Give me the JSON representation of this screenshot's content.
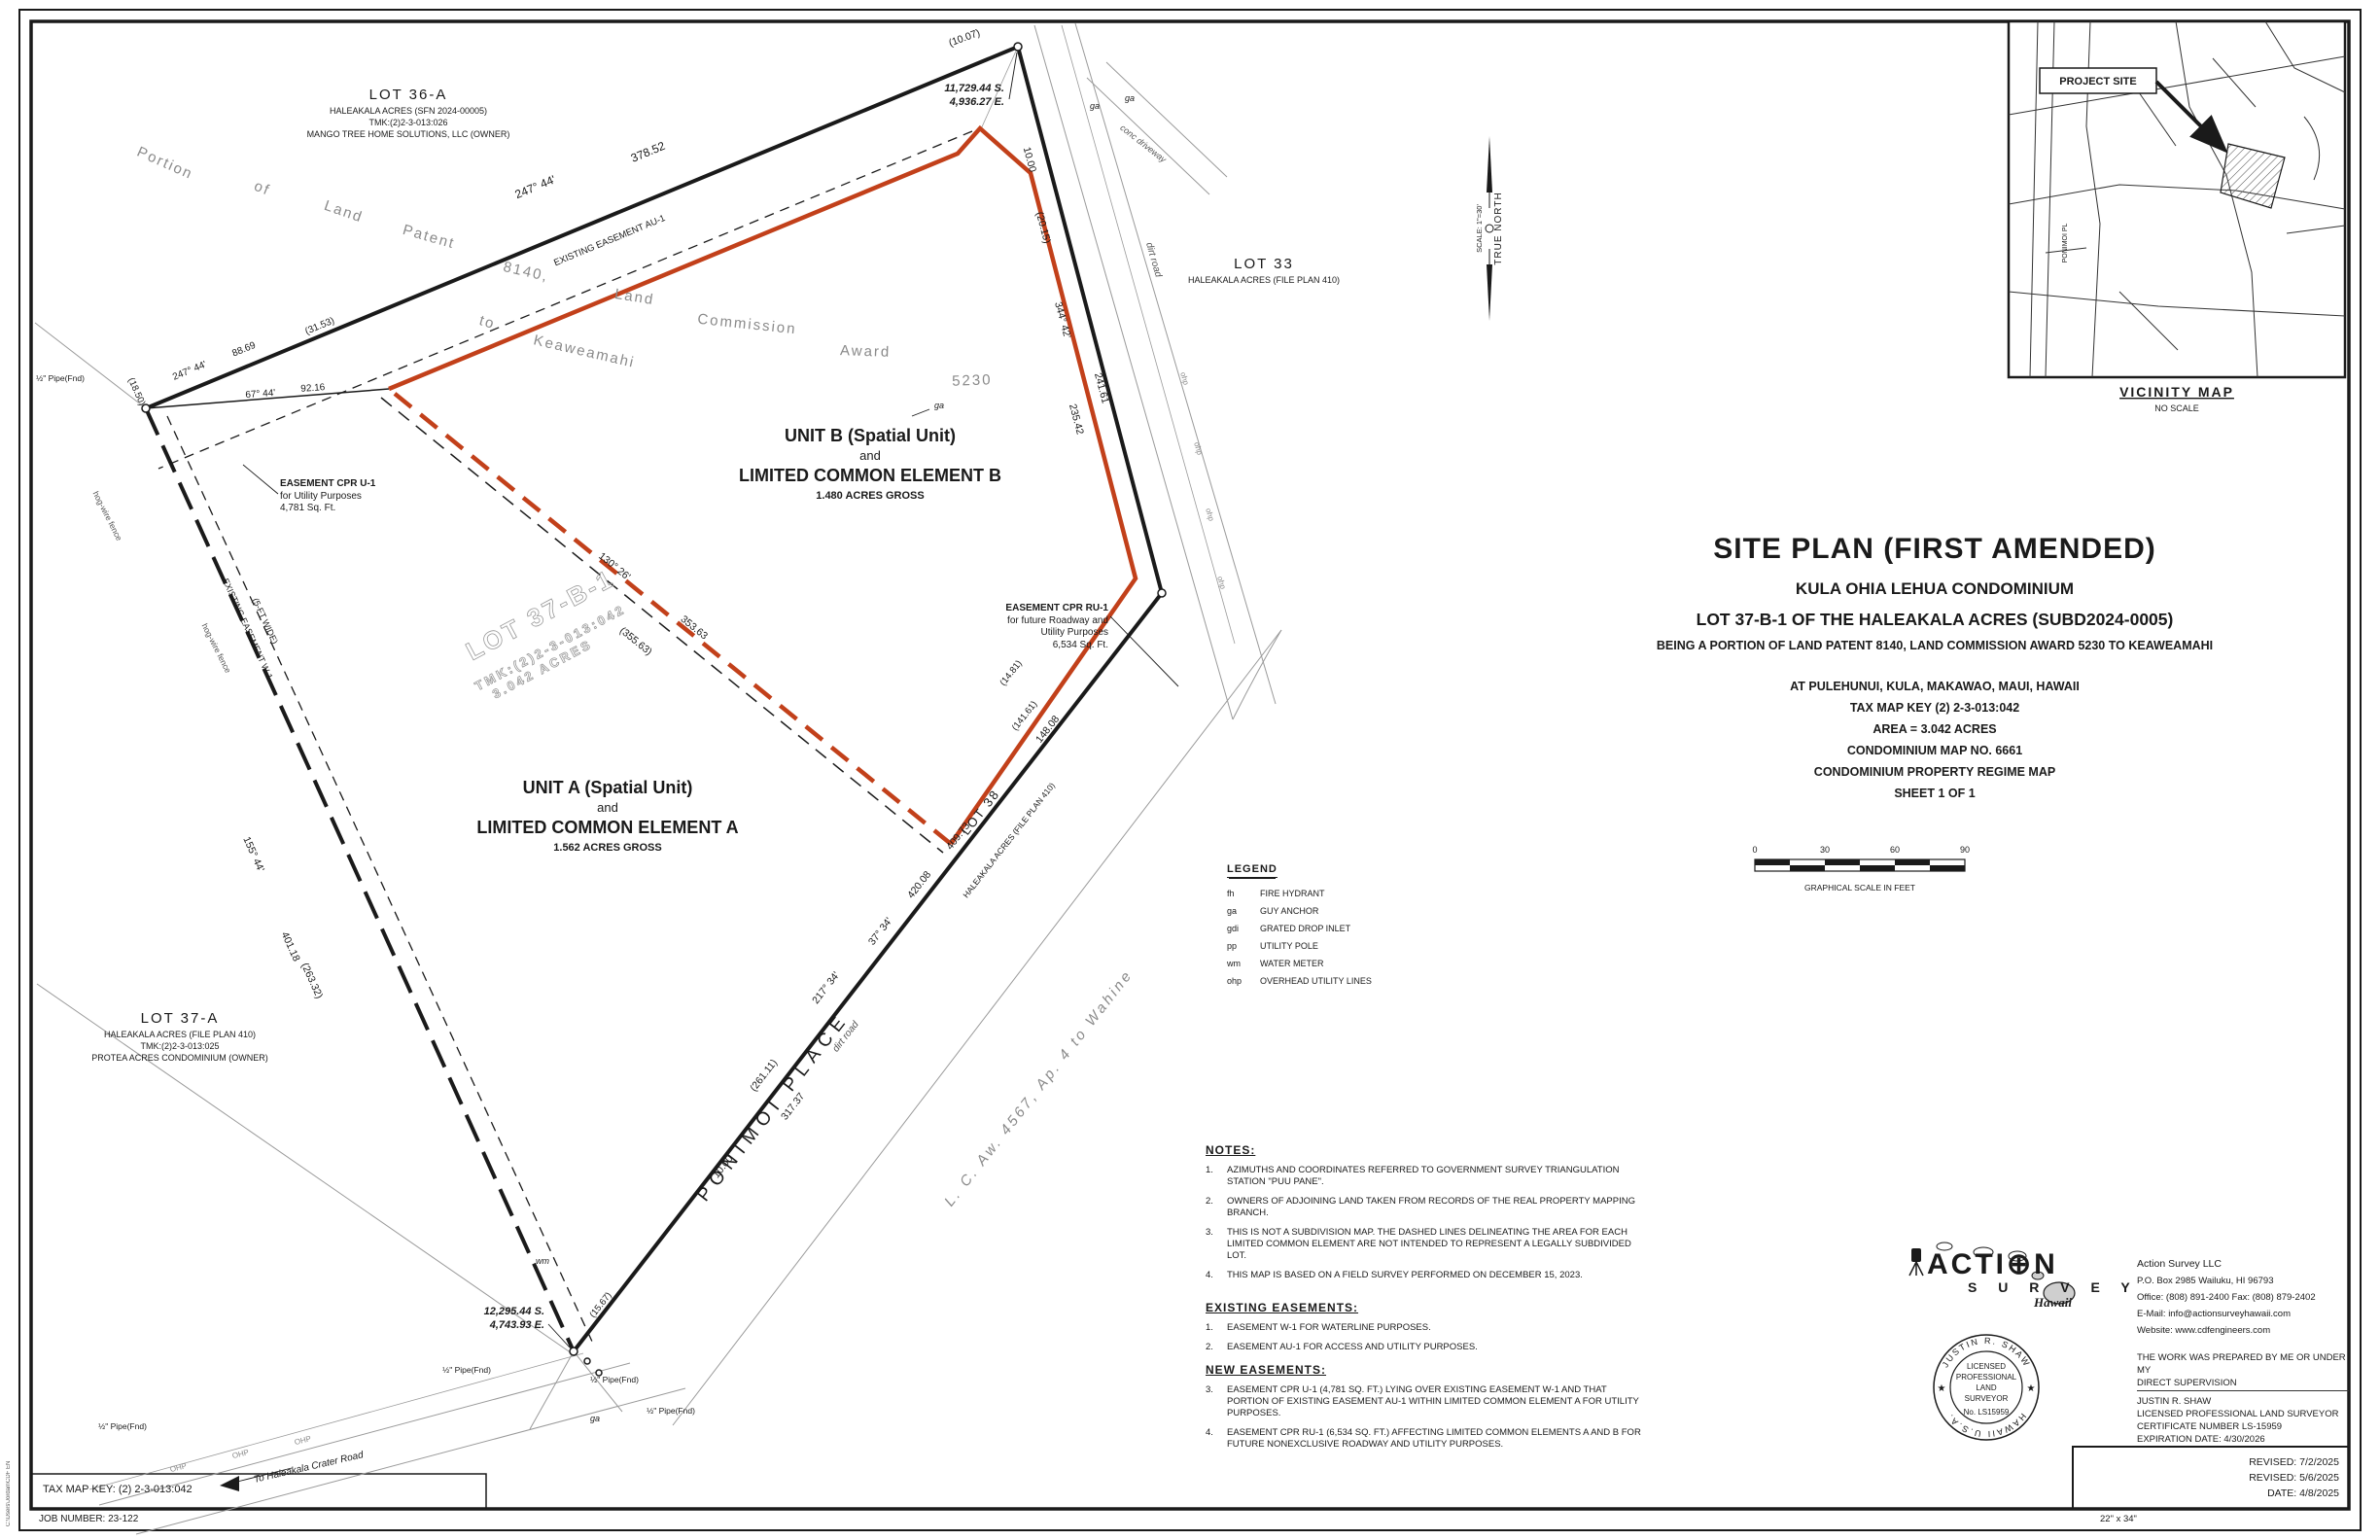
{
  "page": {
    "sheet_note": "22\" x 34\"",
    "tax_map_key": "TAX MAP KEY: (2) 2-3-013:042",
    "job_number": "JOB NUMBER: 23-122",
    "file_path": "C:\\Users\\Jordan\\CDF EN",
    "revisions": [
      "REVISED: 7/2/2025",
      "REVISED: 5/6/2025",
      "DATE: 4/8/2025"
    ]
  },
  "colors": {
    "boundary_red": "#c2401a",
    "line_black": "#1a1a1a",
    "line_gray": "#9a9a9a"
  },
  "vicinity": {
    "title": "VICINITY MAP",
    "subtitle": "NO SCALE",
    "project_site": "PROJECT SITE",
    "road_label": "PONIMOI PL"
  },
  "north": {
    "label": "TRUE NORTH",
    "scale": "SCALE: 1\"=30'"
  },
  "title_block": {
    "line1": "SITE PLAN (FIRST AMENDED)",
    "line2": "KULA OHIA LEHUA CONDOMINIUM",
    "line3": "LOT 37-B-1 OF THE HALEAKALA ACRES (SUBD2024-0005)",
    "line4": "BEING A PORTION OF LAND PATENT 8140, LAND COMMISSION AWARD 5230 TO KEAWEAMAHI",
    "line5": "AT PULEHUNUI, KULA, MAKAWAO, MAUI, HAWAII",
    "line6": "TAX MAP KEY (2) 2-3-013:042",
    "line7": "AREA = 3.042 ACRES",
    "line8": "CONDOMINIUM MAP NO. 6661",
    "line9": "CONDOMINIUM PROPERTY REGIME MAP",
    "line10": "SHEET 1 OF 1"
  },
  "scale_bar": {
    "ticks": [
      "0",
      "30",
      "60",
      "90"
    ],
    "caption": "GRAPHICAL SCALE IN FEET"
  },
  "legend": {
    "title": "LEGEND",
    "items": [
      {
        "abbr": "fh",
        "label": "FIRE HYDRANT"
      },
      {
        "abbr": "ga",
        "label": "GUY ANCHOR"
      },
      {
        "abbr": "gdi",
        "label": "GRATED DROP INLET"
      },
      {
        "abbr": "pp",
        "label": "UTILITY POLE"
      },
      {
        "abbr": "wm",
        "label": "WATER METER"
      },
      {
        "abbr": "ohp",
        "label": "OVERHEAD UTILITY LINES"
      }
    ]
  },
  "notes": {
    "title": "NOTES:",
    "items": [
      {
        "num": "1.",
        "text": "AZIMUTHS AND COORDINATES REFERRED TO GOVERNMENT SURVEY TRIANGULATION STATION \"PUU PANE\"."
      },
      {
        "num": "2.",
        "text": "OWNERS OF ADJOINING LAND TAKEN FROM RECORDS OF THE REAL PROPERTY MAPPING BRANCH."
      },
      {
        "num": "3.",
        "text": "THIS IS NOT A SUBDIVISION MAP. THE DASHED LINES DELINEATING THE AREA FOR EACH LIMITED COMMON ELEMENT ARE NOT INTENDED TO REPRESENT A LEGALLY SUBDIVIDED LOT."
      },
      {
        "num": "4.",
        "text": "THIS MAP IS BASED ON A FIELD SURVEY PERFORMED ON DECEMBER 15, 2023."
      }
    ]
  },
  "existing_easements": {
    "title": "EXISTING EASEMENTS:",
    "items": [
      {
        "num": "1.",
        "text": "EASEMENT W-1 FOR WATERLINE PURPOSES."
      },
      {
        "num": "2.",
        "text": "EASEMENT AU-1 FOR ACCESS AND UTILITY PURPOSES."
      }
    ]
  },
  "new_easements": {
    "title": "NEW EASEMENTS:",
    "items": [
      {
        "num": "3.",
        "text": "EASEMENT CPR U-1 (4,781 SQ. FT.) LYING OVER EXISTING EASEMENT W-1 AND THAT PORTION OF EXISTING EASEMENT AU-1 WITHIN LIMITED COMMON ELEMENT A FOR UTILITY PURPOSES."
      },
      {
        "num": "4.",
        "text": "EASEMENT CPR RU-1 (6,534 SQ. FT.) AFFECTING LIMITED COMMON ELEMENTS A AND B FOR FUTURE NONEXCLUSIVE ROADWAY AND UTILITY PURPOSES."
      }
    ]
  },
  "firm": {
    "logo_action": "ACTI⊕N",
    "logo_survey": "S U R V E Y",
    "logo_hawaii": "Hawaii",
    "name": "Action Survey LLC",
    "address": "P.O. Box 2985 Wailuku, HI 96793",
    "phones": "Office: (808) 891-2400  Fax: (808) 879-2402",
    "email": "E-Mail: info@actionsurveyhawaii.com",
    "website": "Website: www.cdfengineers.com",
    "supervision1": "THE WORK WAS PREPARED BY ME OR UNDER MY",
    "supervision2": "DIRECT SUPERVISION",
    "surveyor_name": "JUSTIN R. SHAW",
    "surveyor_title": "LICENSED PROFESSIONAL LAND SURVEYOR",
    "certificate": "CERTIFICATE NUMBER LS-15959",
    "expiration": "EXPIRATION DATE: 4/30/2026",
    "stamp": {
      "arc_top": "JUSTIN R. SHAW",
      "arc_bottom": "HAWAII   U.S.A.",
      "l1": "LICENSED",
      "l2": "PROFESSIONAL",
      "l3": "LAND",
      "l4": "SURVEYOR",
      "l5": "No. LS15959",
      "star": "★"
    }
  },
  "map": {
    "lot36a": {
      "l1": "LOT 36-A",
      "l2": "HALEAKALA ACRES (SFN 2024-00005)",
      "l3": "TMK:(2)2-3-013:026",
      "l4": "MANGO TREE HOME SOLUTIONS, LLC (OWNER)"
    },
    "lot33": {
      "l1": "LOT 33",
      "l2": "HALEAKALA ACRES (FILE PLAN 410)"
    },
    "lot37a": {
      "l1": "LOT 37-A",
      "l2": "HALEAKALA ACRES (FILE PLAN 410)",
      "l3": "TMK:(2)2-3-013:025",
      "l4": "PROTEA ACRES CONDOMINIUM (OWNER)"
    },
    "lot38": {
      "l1": "LOT 38",
      "l2": "HALEAKALA ACRES (FILE PLAN 410)"
    },
    "parcel": {
      "l1": "LOT 37-B-1",
      "l2": "TMK:(2)2-3-013:042",
      "l3": "3.042 ACRES"
    },
    "unit_b": {
      "l1": "UNIT B (Spatial Unit)",
      "l2": "and",
      "l3": "LIMITED COMMON ELEMENT B",
      "l4": "1.480 ACRES GROSS"
    },
    "unit_a": {
      "l1": "UNIT A (Spatial Unit)",
      "l2": "and",
      "l3": "LIMITED COMMON ELEMENT A",
      "l4": "1.562 ACRES GROSS"
    },
    "cpr_u1": {
      "l1": "EASEMENT CPR U-1",
      "l2": "for Utility Purposes",
      "l3": "4,781 Sq. Ft."
    },
    "cpr_ru1": {
      "l1": "EASEMENT CPR RU-1",
      "l2": "for future Roadway and",
      "l3": "Utility Purposes",
      "l4": "6,534 Sq. Ft."
    },
    "coords_top": {
      "l1": "11,729.44 S.",
      "l2": "4,936.27 E."
    },
    "coords_bottom": {
      "l1": "12,295.44 S.",
      "l2": "4,743.93 E."
    },
    "arc": {
      "w1": "Portion",
      "w2": "of",
      "w3": "Land",
      "w4": "Patent",
      "w5": "8140,",
      "w6": "Land",
      "w7": "Commission",
      "w8": "Award",
      "w9": "5230",
      "w10": "to",
      "w11": "Keaweamahi"
    },
    "b": {
      "top_brg": "247° 44'",
      "top_dist": "378.52",
      "au1": "EXISTING EASEMENT AU-1",
      "b2_brg": "247° 44'",
      "b2_dist": "88.69",
      "p3153": "(31.53)",
      "tie_brg": "67° 44'",
      "tie_dist": "92.16",
      "r_1000": "10.00",
      "p2015": "(20.15)",
      "r_brg": "344° 42'",
      "r_d1": "235.42",
      "r_d2": "241.61",
      "p1481": "(14.81)",
      "p14161": "(141.61)",
      "d14808": "148.08",
      "diag_brg": "130° 26'",
      "diag_d": "353.63",
      "diag_p": "(355.63)",
      "l_brg": "155° 44'",
      "l_d": "401.18",
      "l_p": "(263.32)",
      "w1a": "EXISTING EASEMENT W-1",
      "w1b": "(5-FT WIDE)",
      "pon_brg1": "217° 34'",
      "pon_brg2": "37° 34'",
      "pon_d1": "420.08",
      "pon_d2": "409.73",
      "pon_p": "(261.11)",
      "pon_317": "317.37",
      "pon_1000": "10.00",
      "p1007": "(10.07)",
      "p1567": "(15.67)",
      "p1850": "(18.50)"
    },
    "misc": {
      "dirt_road": "dirt road",
      "conc": "conc driveway",
      "hog": "hog-wire fence",
      "to_road": "To Haleakala Crater Road",
      "ponimoi": "PONIMOI  PLACE",
      "lc": "L. C. Aw. 4567, Ap. 4 to Wahine",
      "pipe": "½\" Pipe(Fnd)",
      "ohp": "ohp",
      "ohp2": "OHP",
      "ga": "ga",
      "wm": "wm"
    }
  }
}
